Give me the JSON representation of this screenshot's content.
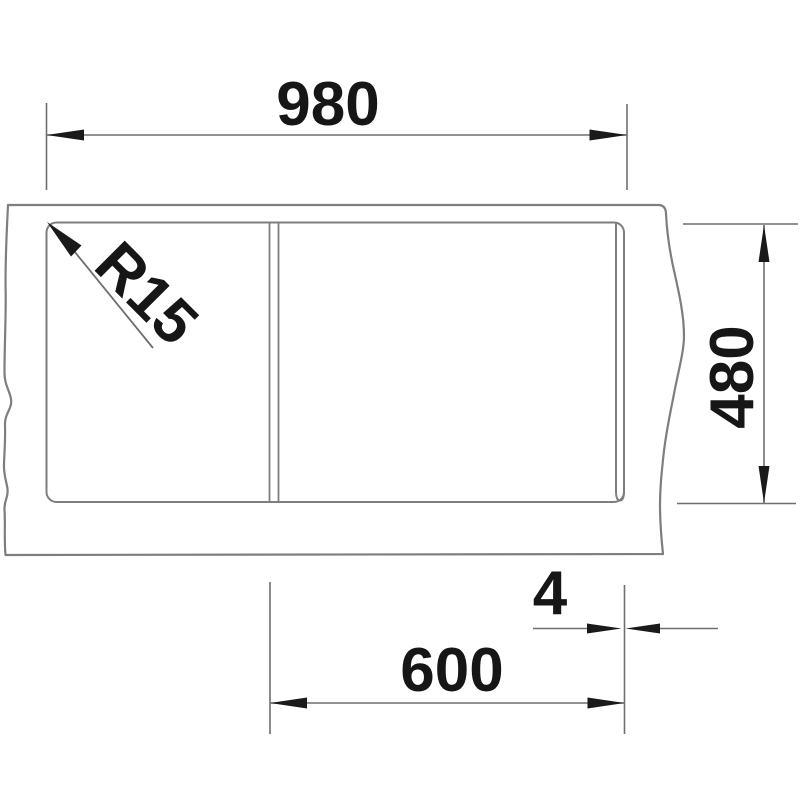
{
  "drawing": {
    "kind": "technical-dimension-drawing",
    "dimensions": [
      {
        "id": "overall-width",
        "value": "980",
        "orientation": "horizontal"
      },
      {
        "id": "depth",
        "value": "480",
        "orientation": "vertical"
      },
      {
        "id": "bowl-width",
        "value": "600",
        "orientation": "horizontal"
      },
      {
        "id": "edge-offset",
        "value": "4",
        "orientation": "horizontal"
      },
      {
        "id": "corner-radius",
        "value": "R15",
        "orientation": "diagonal"
      }
    ],
    "colors": {
      "background": "#ffffff",
      "line": "#7e7e7e",
      "dimension_line": "#6f6f6f",
      "ink": "#161616"
    }
  }
}
